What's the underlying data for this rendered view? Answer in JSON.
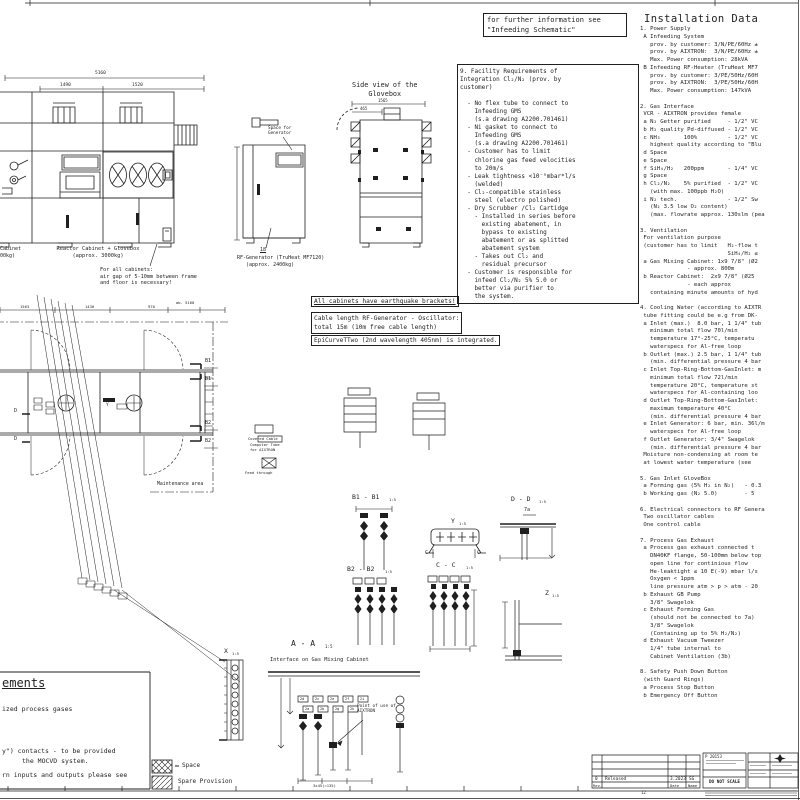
{
  "colors": {
    "ink": "#1f1f1f",
    "paper": "#ffffff"
  },
  "top_note": "for further information see\n\"Infeeding Schematic\"",
  "installation": {
    "title": "Installation Data",
    "body": "1. Power Supply\n A Infeeding System\n   prov. by customer: 3/N/PE/60Hz ±\n   prov. by AIXTRON:  3/N/PE/60Hz ±\n   Max. Power consumption: 28kVA\n B Infeeding RF-Heater (TruHeat MF7\n   prov. by customer: 3/PE/50Hz/60H\n   prov. by AIXTRON:  3/PE/50Hz/60H\n   Max. Power consumption: 147kVA\n\n2. Gas Interface\n VCR - AIXTRON provides female\n a N₂ Getter purified     - 1/2\" VC\n b H₂ quality Pd-diffused - 1/2\" VC\n c NH₃       100%         - 1/2\" VC\n   highest quality according to \"Blu\n d Space\n e Space\n f SiH₄/H₂   200ppm       - 1/4\" VC\n g Space\n h Cl₂/N₂    5% purified  - 1/2\" VC\n   (with max. 100ppb H₂O)\n i N₂ tech.               - 1/2\" Sw\n   (N₂ 3.5 low O₂ content)\n   (max. flowrate approx. 130slm (pea\n\n3. Ventilation\n For ventilation purpose\n (customer has to limit   H₂-flow t\n                          SiH₄/H₂ ≤\n a Gas Mixing Cabinet: 1x9 7/8\" (Ø2\n              - approx. 800m\n b Reactor Cabinet:  2x9 7/8\" (Ø25\n              - each approx\n   containing minute amounts of hyd\n\n4. Cooling Water (according to AIXTR\n tube fitting could be e.g from DK-\n a Inlet (max.)  8.0 bar, 1 1/4\" tub\n   minimum total flow 70l/min\n   temperature 17°-25°C, temperatu\n   waterspecs for Al-free loop\n b Outlet (max.) 2.5 bar, 1 1/4\" tub\n   (min. differential pressure 4 bar\n c Inlet Top-Ring-Bottom-GasInlet: m\n   minimum total flow 72l/min\n   temperature 20°C, temperature st\n   waterspecs for Al-containing loo\n d Outlet Top-Ring-Bottom-GasInlet:\n   maximum temperature 40°C\n   (min. differential pressure 4 bar\n e Inlet Generator: 6 bar, min. 36l/m\n   waterspecs for Al-free loop\n f Outlet Generator: 3/4\" Swagelok\n   (min. differential pressure 4 bar\n Moisture non-condensing at room te\n at lowest water temperature (see\n\n5. Gas Inlet GloveBox\n a Forming gas (5% H₂ in N₂)   - 0.3\n b Working gas (N₂ 5.0)        - 5\n\n6. Electrical connectors to RF Genera\n Two oscillator cables\n One control cable\n\n7. Process Gas Exhaust\n a Process gas exhaust connected t\n   DN40KF flange, 50-100mm below top\n   open line for continious flow\n   He-leaktight ≤ 10 E(-9) mbar l/s\n   Oxygen < 1ppm\n   line pressure atm > p > atm - 20\n b Exhaust GB Pump\n   3/8\" Swagelok\n c Exhaust Forming Gas\n   (should not be connected to 7a)\n   3/8\" Swagelok\n   (Containing up to 5% H₂/N₂)\n d Exhaust Vacuum Tweezer\n   1/4\" tube internal to\n   Cabinet Ventilation (3b)\n\n8. Safety Push Down Button\n (with Guard Rings)\n a Process Stop Button\n b Emergency Off Button"
  },
  "facility_box": "9. Facility Requirements of\nIntegration Cl₂/N₂ (prov. by\ncustomer)\n\n  - No flex tube to connect to\n    Infeeding GMS\n    (s.a drawing A2200.701461)\n  - Ni gasket to connect to\n    Infeeding GMS\n    (s.a drawing A2200.701461)\n  - Customer has to limit\n    chlorine gas feed velocities\n    to 20m/s\n  - Leak tightness <10⁻⁹mbar*l/s\n    (welded)\n  - Cl₂-compatible stainless\n    steel (electro polished)\n  - Dry Scrubber /Cl₂ Cartidge\n    - Installed in series before\n      existing abatement, in\n      bypass to existing\n      abatement or as splitted\n      abatement system\n    - Takes out Cl₂ and\n      residual precursor\n  - Customer is responsible for\n    infeed Cl₂/N₂ 5% 5.0 or\n    better via purifier to\n    the system.",
  "notes": {
    "earthquake": "All cabinets have earthquake brackets!",
    "cable": "Cable length RF-Generator - Oscillator:\ntotal 15m (10m free cable length)",
    "epicurve": "EpiCurveTTwo (2nd wavelength 405nm) is integrated."
  },
  "elevation": {
    "dim_total": "5160",
    "dim_left": "1490",
    "dim_right": "1520",
    "label_left": "Cabinet\n00kg)",
    "label_main": "Reactor Cabinet + Glovebox\n(approx. 3000kg)",
    "note_floor": "For all cabinets:\nair gap of 5-10mm between frame\nand floor is necessary!"
  },
  "rf_generator": {
    "space_label": "Space for\nGenerator",
    "balloon": "18",
    "label": "RF-Generator (TruHeat MF7120)\n   (approx. 2400kg)"
  },
  "side_view": {
    "title": "Side view of the\n    Glovebox",
    "dim1": "1565",
    "dim2": "465"
  },
  "plan": {
    "dim_total": "ab. 5160",
    "dim_a": "1563",
    "dim_b": "1430",
    "dim_c": "970",
    "y_tag": "Y",
    "d_tag": "D",
    "b1": "B1",
    "b2": "B2",
    "maintenance": "Maintenance area"
  },
  "mid_labels": {
    "covered_cable": "Covered Cable",
    "computer_tube": "Computer Tube\nfor AIXTRON",
    "feed_through": "Feed through"
  },
  "sections": {
    "y": {
      "name": "Y",
      "scale": "1:5",
      "c_mark": "C"
    },
    "cc": {
      "name": "C - C",
      "scale": "1:5"
    },
    "b1": {
      "name": "B1 - B1",
      "scale": "1:5"
    },
    "b2": {
      "name": "B2 - B2",
      "scale": "1:5"
    },
    "dd": {
      "name": "D - D",
      "scale": "1:5",
      "ref": "7a"
    },
    "z": {
      "name": "Z",
      "scale": "1:5"
    },
    "x": {
      "name": "X",
      "scale": "1:5"
    },
    "aa": {
      "name": "A - A",
      "scale": "1:5",
      "subtitle": "Interface on Gas Mixing Cabinet",
      "point_of_use": "Point of use of\nAIXTRON",
      "dim": "3x45(=135)",
      "tags_row1": [
        "2d",
        "2c",
        "2e",
        "2f",
        "2i"
      ],
      "tags_row2": [
        "2a",
        "2b",
        "2g",
        "2h"
      ]
    }
  },
  "legend": {
    "space": "Space",
    "spare": "Spare Provision"
  },
  "partial_box": {
    "heading": "ements",
    "line1": "ized process gases",
    "line2": "y\") contacts - to be provided",
    "line3": "the MOCVD system.",
    "line4": "rn inputs and outputs please see"
  },
  "title_block": {
    "rev": "0",
    "rev_desc": "Released",
    "rev_date": "3.2023",
    "rev_name": "SG",
    "col_rev": "Rev.",
    "col_date": "Date",
    "col_name": "Name",
    "doc_no": "P 20153",
    "no_scale": "DO NOT SCALE",
    "grid_ref": "12"
  }
}
